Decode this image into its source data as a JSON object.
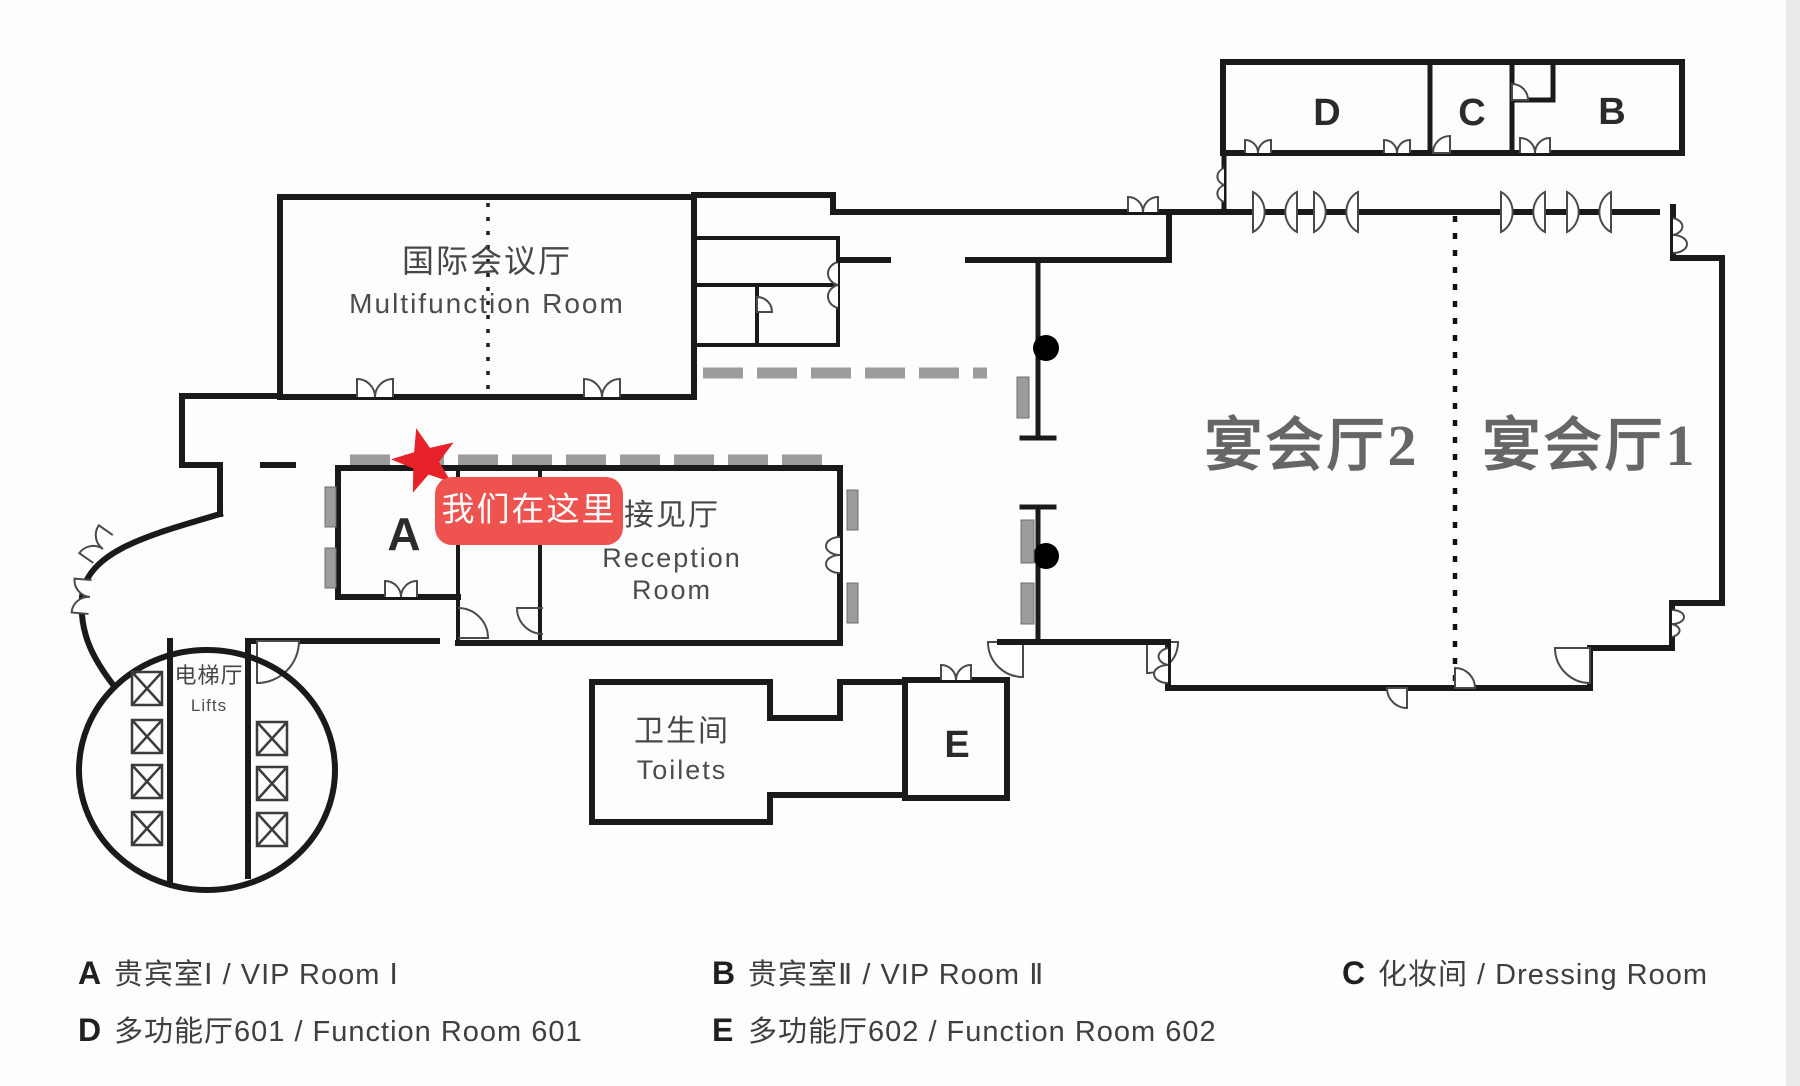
{
  "meta": {
    "title": "会议楼层平面图 Floor Plan"
  },
  "colors": {
    "wall": "#1a1a1a",
    "door": "#4a4a4a",
    "partition_gray": "#9c9c9c",
    "star_red": "#e62129",
    "badge_bg": "#ee5350",
    "badge_text": "#ffffff",
    "banquet_label": "#666666",
    "label": "#474747"
  },
  "rooms": {
    "multifunction": {
      "zh": "国际会议厅",
      "en": "Multifunction Room"
    },
    "reception": {
      "zh": "接见厅",
      "en1": "Reception",
      "en2": "Room"
    },
    "banquet2": {
      "zh": "宴会厅2"
    },
    "banquet1": {
      "zh": "宴会厅1"
    },
    "toilets": {
      "zh": "卫生间",
      "en": "Toilets"
    },
    "lifts": {
      "zh": "电梯厅",
      "en": "Lifts"
    },
    "a": "A",
    "b": "B",
    "c": "C",
    "d": "D",
    "e": "E"
  },
  "marker": {
    "label": "我们在这里"
  },
  "legend": [
    {
      "letter": "A",
      "desc": "贵宾室Ⅰ / VIP Room Ⅰ"
    },
    {
      "letter": "B",
      "desc": "贵宾室Ⅱ / VIP Room Ⅱ"
    },
    {
      "letter": "C",
      "desc": "化妆间 / Dressing Room"
    },
    {
      "letter": "D",
      "desc": "多功能厅601 / Function Room 601"
    },
    {
      "letter": "E",
      "desc": "多功能厅602 / Function Room 602"
    }
  ]
}
